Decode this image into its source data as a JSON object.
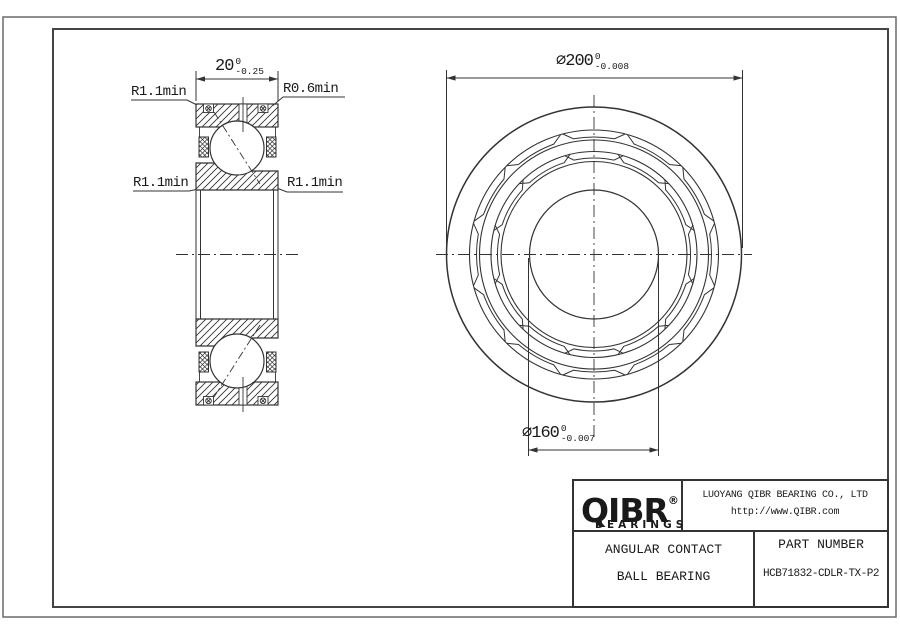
{
  "drawing": {
    "left_view_labels": {
      "top_left": "R1.1min",
      "top_right": "R0.6min",
      "mid_left": "R1.1min",
      "mid_right": "R1.1min"
    },
    "dimensions": {
      "width": {
        "value": "20",
        "upper": "0",
        "lower": "-0.25"
      },
      "outer_diameter": {
        "symbol": "⌀",
        "value": "200",
        "upper": "0",
        "lower": "-0.008"
      },
      "bore_diameter": {
        "symbol": "⌀",
        "value": "160",
        "upper": "0",
        "lower": "-0.007"
      }
    },
    "line_color": "#333333"
  },
  "title_block": {
    "brand": "QIBR",
    "brand_mark": "®",
    "brand_sub": "BEARINGS",
    "company": "LUOYANG QIBR BEARING CO., LTD",
    "website": "http://www.QIBR.com",
    "product_type_line1": "ANGULAR CONTACT",
    "product_type_line2": "BALL BEARING",
    "part_number_label": "PART NUMBER",
    "part_number": "HCB71832-CDLR-TX-P2"
  }
}
